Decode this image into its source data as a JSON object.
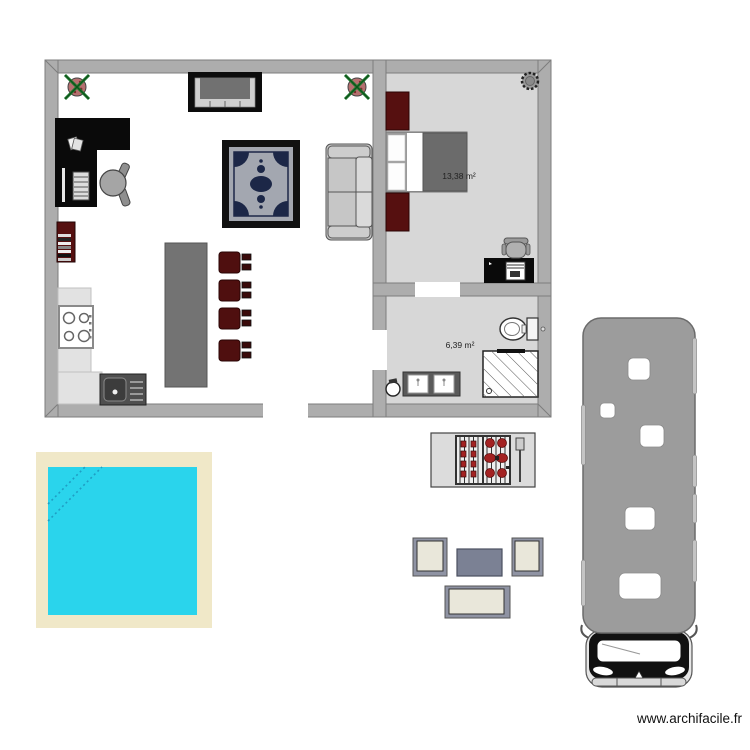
{
  "app": {
    "watermark": "www.archifacile.fr"
  },
  "plan": {
    "rooms": [
      {
        "id": "bedroom",
        "area_label": "13,38 m²"
      },
      {
        "id": "bathroom",
        "area_label": "6,39 m²"
      }
    ],
    "objects": [
      "potted-plant",
      "tv-sideboard",
      "l-desk",
      "office-chair",
      "bookshelf",
      "cooktop",
      "kitchen-sink",
      "kitchen-counter",
      "kitchen-island",
      "bar-stool",
      "rug",
      "sofa",
      "wardrobe",
      "double-bed",
      "ceiling-fan",
      "bedroom-desk",
      "desk-chair",
      "toilet",
      "shower",
      "double-vanity",
      "pedestal-bin",
      "swimming-pool",
      "bbq-grill",
      "garden-armchair",
      "garden-table",
      "garden-sofa",
      "motorhome"
    ]
  },
  "colors": {
    "wall": "#adadad",
    "wall-outline": "#7d7d7d",
    "floor-room": "#d7d7d7",
    "floor-living": "#ffffff",
    "maroon": "#561010",
    "stool-maroon": "#4f0f0f",
    "island-gray": "#737373",
    "rug-field": "#a3a7b0",
    "rug-motif": "#1c2747",
    "duvet": "#6b6b6b",
    "pool-border": "#f0e8c8",
    "pool-water": "#2ad4ec",
    "pool-steps": "#1f9ec4",
    "rv-body": "#9c9c9c",
    "cushion-cream": "#e9e7da",
    "garden-frame": "#8f93a3",
    "garden-table": "#7b8194",
    "food-red": "#a32222",
    "plant-pot": "#b57070",
    "plant-leaf": "#1e7a2e"
  }
}
